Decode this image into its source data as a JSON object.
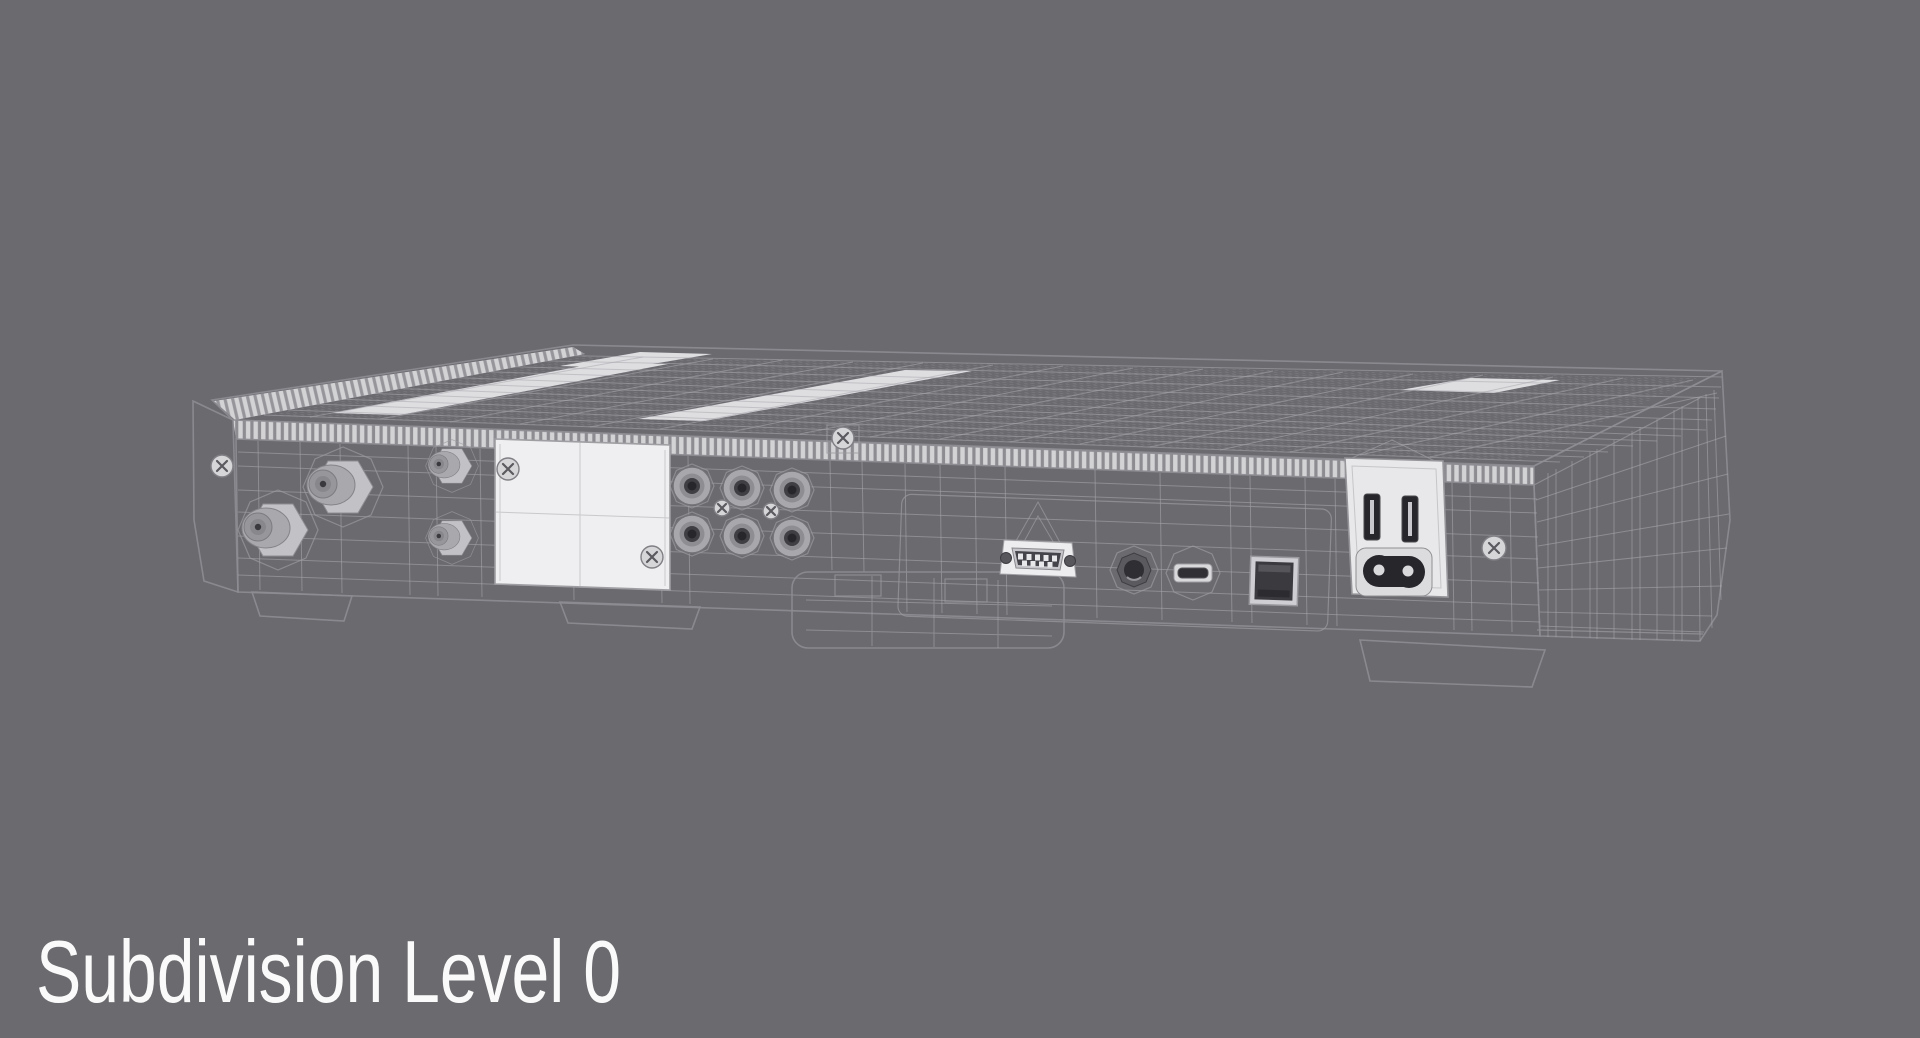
{
  "scene": {
    "background_color": "#6a6a6f",
    "caption": "Subdivision Level 0",
    "caption_color": "#fafafa"
  },
  "device": {
    "description": "rear view of a set-top box 3D model rendered with subdivision wireframe overlay",
    "body_color": "#eaeaec",
    "top_color": "#d9d9dc",
    "side_color": "#e3e3e6",
    "bevel_color": "#d3d3d6",
    "plate_color": "#efeff1",
    "vent_dot_color": "#7e7e83",
    "wireframe_color": "#a9a9ae",
    "dark_port_color": "#2c2c31",
    "metal_color": "#a5a5a9",
    "ports": [
      "coax-f-connector-large-1",
      "coax-f-connector-large-2",
      "coax-f-connector-small-1",
      "coax-f-connector-small-2",
      "blank-cover-plate",
      "rca-jack-1",
      "rca-jack-2",
      "rca-jack-3",
      "rca-jack-4",
      "rca-jack-5",
      "rca-jack-6",
      "db9-serial-port",
      "audio-jack-3-5mm",
      "mini-usb-port",
      "optical-audio-port",
      "power-switch-slots",
      "c7-power-inlet"
    ]
  }
}
